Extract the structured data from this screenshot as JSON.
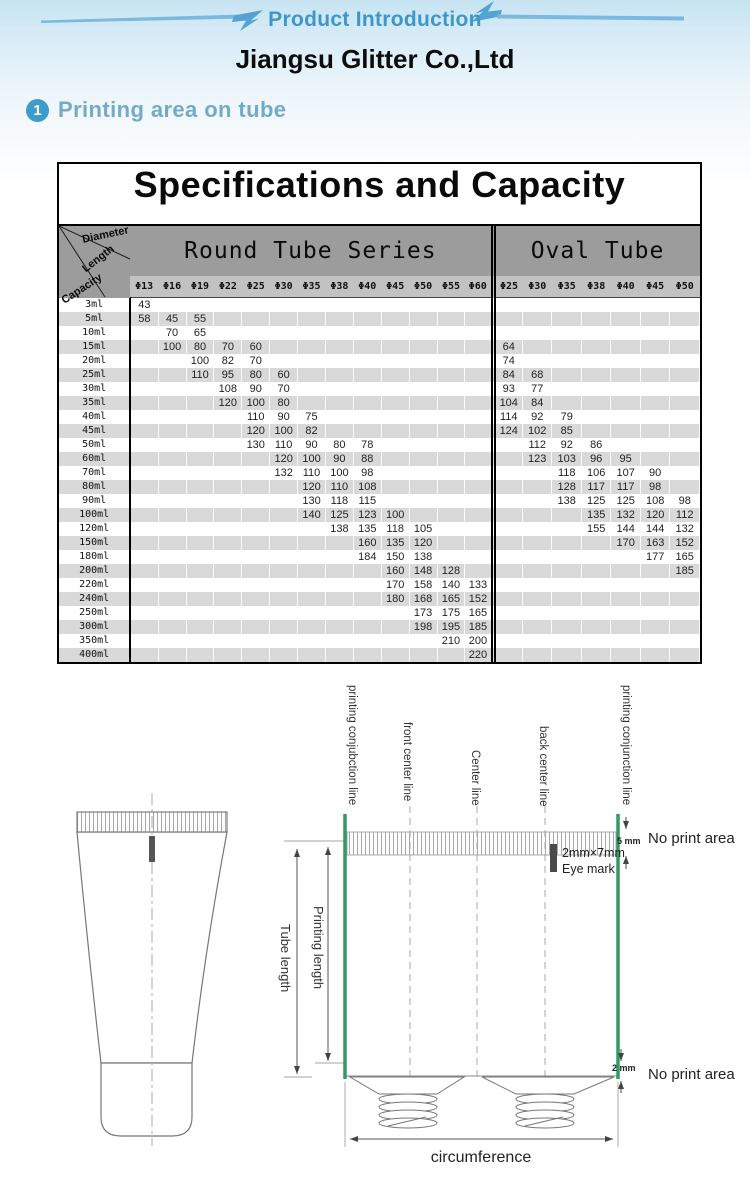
{
  "header": {
    "banner": "Product Introduction",
    "company": "Jiangsu Glitter Co.,Ltd"
  },
  "section": {
    "number": "1",
    "title": "Printing area on tube"
  },
  "colors": {
    "accent_blue": "#3f96c8",
    "section_blue": "#74aac9",
    "badge_blue": "#3e9ccb",
    "header_gray": "#9c9c9c",
    "subheader_gray": "#c2c2c2",
    "row_stripe_gray": "#d9d9d9",
    "guide_line_green": "#339966"
  },
  "table": {
    "title": "Specifications and Capacity",
    "corner": {
      "diameter": "Diameter",
      "length": "Length",
      "capacity": "Capacity"
    },
    "groups": [
      {
        "label": "Round Tube Series",
        "columns": [
          "Φ13",
          "Φ16",
          "Φ19",
          "Φ22",
          "Φ25",
          "Φ30",
          "Φ35",
          "Φ38",
          "Φ40",
          "Φ45",
          "Φ50",
          "Φ55",
          "Φ60"
        ]
      },
      {
        "label": "Oval Tube",
        "columns": [
          "Φ25",
          "Φ30",
          "Φ35",
          "Φ38",
          "Φ40",
          "Φ45",
          "Φ50"
        ]
      }
    ],
    "rows": [
      {
        "capacity": "3ml",
        "round": [
          "43",
          "",
          "",
          "",
          "",
          "",
          "",
          "",
          "",
          "",
          "",
          "",
          ""
        ],
        "oval": [
          "",
          "",
          "",
          "",
          "",
          "",
          ""
        ]
      },
      {
        "capacity": "5ml",
        "round": [
          "58",
          "45",
          "55",
          "",
          "",
          "",
          "",
          "",
          "",
          "",
          "",
          "",
          ""
        ],
        "oval": [
          "",
          "",
          "",
          "",
          "",
          "",
          ""
        ]
      },
      {
        "capacity": "10ml",
        "round": [
          "",
          "70",
          "65",
          "",
          "",
          "",
          "",
          "",
          "",
          "",
          "",
          "",
          ""
        ],
        "oval": [
          "",
          "",
          "",
          "",
          "",
          "",
          ""
        ]
      },
      {
        "capacity": "15ml",
        "round": [
          "",
          "100",
          "80",
          "70",
          "60",
          "",
          "",
          "",
          "",
          "",
          "",
          "",
          ""
        ],
        "oval": [
          "64",
          "",
          "",
          "",
          "",
          "",
          ""
        ]
      },
      {
        "capacity": "20ml",
        "round": [
          "",
          "",
          "100",
          "82",
          "70",
          "",
          "",
          "",
          "",
          "",
          "",
          "",
          ""
        ],
        "oval": [
          "74",
          "",
          "",
          "",
          "",
          "",
          ""
        ]
      },
      {
        "capacity": "25ml",
        "round": [
          "",
          "",
          "110",
          "95",
          "80",
          "60",
          "",
          "",
          "",
          "",
          "",
          "",
          ""
        ],
        "oval": [
          "84",
          "68",
          "",
          "",
          "",
          "",
          ""
        ]
      },
      {
        "capacity": "30ml",
        "round": [
          "",
          "",
          "",
          "108",
          "90",
          "70",
          "",
          "",
          "",
          "",
          "",
          "",
          ""
        ],
        "oval": [
          "93",
          "77",
          "",
          "",
          "",
          "",
          ""
        ]
      },
      {
        "capacity": "35ml",
        "round": [
          "",
          "",
          "",
          "120",
          "100",
          "80",
          "",
          "",
          "",
          "",
          "",
          "",
          ""
        ],
        "oval": [
          "104",
          "84",
          "",
          "",
          "",
          "",
          ""
        ]
      },
      {
        "capacity": "40ml",
        "round": [
          "",
          "",
          "",
          "",
          "110",
          "90",
          "75",
          "",
          "",
          "",
          "",
          "",
          ""
        ],
        "oval": [
          "114",
          "92",
          "79",
          "",
          "",
          "",
          ""
        ]
      },
      {
        "capacity": "45ml",
        "round": [
          "",
          "",
          "",
          "",
          "120",
          "100",
          "82",
          "",
          "",
          "",
          "",
          "",
          ""
        ],
        "oval": [
          "124",
          "102",
          "85",
          "",
          "",
          "",
          ""
        ]
      },
      {
        "capacity": "50ml",
        "round": [
          "",
          "",
          "",
          "",
          "130",
          "110",
          "90",
          "80",
          "78",
          "",
          "",
          "",
          ""
        ],
        "oval": [
          "",
          "112",
          "92",
          "86",
          "",
          "",
          ""
        ]
      },
      {
        "capacity": "60ml",
        "round": [
          "",
          "",
          "",
          "",
          "",
          "120",
          "100",
          "90",
          "88",
          "",
          "",
          "",
          ""
        ],
        "oval": [
          "",
          "123",
          "103",
          "96",
          "95",
          "",
          ""
        ]
      },
      {
        "capacity": "70ml",
        "round": [
          "",
          "",
          "",
          "",
          "",
          "132",
          "110",
          "100",
          "98",
          "",
          "",
          "",
          ""
        ],
        "oval": [
          "",
          "",
          "118",
          "106",
          "107",
          "90",
          ""
        ]
      },
      {
        "capacity": "80ml",
        "round": [
          "",
          "",
          "",
          "",
          "",
          "",
          "120",
          "110",
          "108",
          "",
          "",
          "",
          ""
        ],
        "oval": [
          "",
          "",
          "128",
          "117",
          "117",
          "98",
          ""
        ]
      },
      {
        "capacity": "90ml",
        "round": [
          "",
          "",
          "",
          "",
          "",
          "",
          "130",
          "118",
          "115",
          "",
          "",
          "",
          ""
        ],
        "oval": [
          "",
          "",
          "138",
          "125",
          "125",
          "108",
          "98"
        ]
      },
      {
        "capacity": "100ml",
        "round": [
          "",
          "",
          "",
          "",
          "",
          "",
          "140",
          "125",
          "123",
          "100",
          "",
          "",
          ""
        ],
        "oval": [
          "",
          "",
          "",
          "135",
          "132",
          "120",
          "112"
        ]
      },
      {
        "capacity": "120ml",
        "round": [
          "",
          "",
          "",
          "",
          "",
          "",
          "",
          "138",
          "135",
          "118",
          "105",
          "",
          ""
        ],
        "oval": [
          "",
          "",
          "",
          "155",
          "144",
          "144",
          "132"
        ]
      },
      {
        "capacity": "150ml",
        "round": [
          "",
          "",
          "",
          "",
          "",
          "",
          "",
          "",
          "160",
          "135",
          "120",
          "",
          ""
        ],
        "oval": [
          "",
          "",
          "",
          "",
          "170",
          "163",
          "152"
        ]
      },
      {
        "capacity": "180ml",
        "round": [
          "",
          "",
          "",
          "",
          "",
          "",
          "",
          "",
          "184",
          "150",
          "138",
          "",
          ""
        ],
        "oval": [
          "",
          "",
          "",
          "",
          "",
          "177",
          "165"
        ]
      },
      {
        "capacity": "200ml",
        "round": [
          "",
          "",
          "",
          "",
          "",
          "",
          "",
          "",
          "",
          "160",
          "148",
          "128",
          ""
        ],
        "oval": [
          "",
          "",
          "",
          "",
          "",
          "",
          "185"
        ]
      },
      {
        "capacity": "220ml",
        "round": [
          "",
          "",
          "",
          "",
          "",
          "",
          "",
          "",
          "",
          "170",
          "158",
          "140",
          "133"
        ],
        "oval": [
          "",
          "",
          "",
          "",
          "",
          "",
          ""
        ]
      },
      {
        "capacity": "240ml",
        "round": [
          "",
          "",
          "",
          "",
          "",
          "",
          "",
          "",
          "",
          "180",
          "168",
          "165",
          "152"
        ],
        "oval": [
          "",
          "",
          "",
          "",
          "",
          "",
          ""
        ]
      },
      {
        "capacity": "250ml",
        "round": [
          "",
          "",
          "",
          "",
          "",
          "",
          "",
          "",
          "",
          "",
          "173",
          "175",
          "165"
        ],
        "oval": [
          "",
          "",
          "",
          "",
          "",
          "",
          ""
        ]
      },
      {
        "capacity": "300ml",
        "round": [
          "",
          "",
          "",
          "",
          "",
          "",
          "",
          "",
          "",
          "",
          "198",
          "195",
          "185"
        ],
        "oval": [
          "",
          "",
          "",
          "",
          "",
          "",
          ""
        ]
      },
      {
        "capacity": "350ml",
        "round": [
          "",
          "",
          "",
          "",
          "",
          "",
          "",
          "",
          "",
          "",
          "",
          "210",
          "200"
        ],
        "oval": [
          "",
          "",
          "",
          "",
          "",
          "",
          ""
        ]
      },
      {
        "capacity": "400ml",
        "round": [
          "",
          "",
          "",
          "",
          "",
          "",
          "",
          "",
          "",
          "",
          "",
          "",
          "220"
        ],
        "oval": [
          "",
          "",
          "",
          "",
          "",
          "",
          ""
        ]
      }
    ]
  },
  "diagram": {
    "labels": {
      "printing_conjunction_left": "printing conjubction line",
      "front_center": "front center line",
      "center": "Center line",
      "back_center": "back center line",
      "printing_conjunction_right": "printing conjunction line",
      "tube_length": "Tube length",
      "printing_length": "Printing length",
      "eye_mark_size": "2mm×7mm",
      "eye_mark": "Eye mark",
      "top_gap": "5 mm",
      "bottom_gap": "2 mm",
      "no_print_top": "No print area",
      "no_print_bottom": "No print area",
      "circumference": "circumference"
    }
  }
}
